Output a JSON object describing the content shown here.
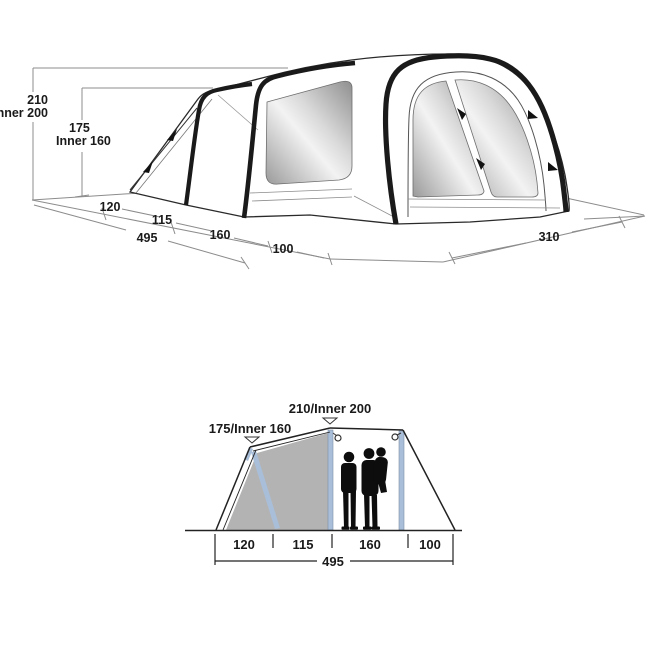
{
  "top_view": {
    "height_primary": "210",
    "height_primary_inner": "Inner 200",
    "height_secondary": "175",
    "height_secondary_inner": "Inner 160",
    "floor_segments": [
      "120",
      "115",
      "160",
      "100"
    ],
    "floor_total": "495",
    "front_width": "310"
  },
  "side_view": {
    "peak_height_label": "210/Inner 200",
    "porch_height_label": "175/Inner 160",
    "floor_segments": [
      "120",
      "115",
      "160",
      "100"
    ],
    "floor_total": "495"
  },
  "colors": {
    "outline": "#1a1a1a",
    "construction_line": "#8c8c8c",
    "pole_blue": "#a9bed8",
    "inner_tent_gray": "#b3b3b3",
    "window_dark": "#8f8f8f",
    "window_light": "#f3f3f3",
    "silhouette": "#0d0d0d"
  }
}
